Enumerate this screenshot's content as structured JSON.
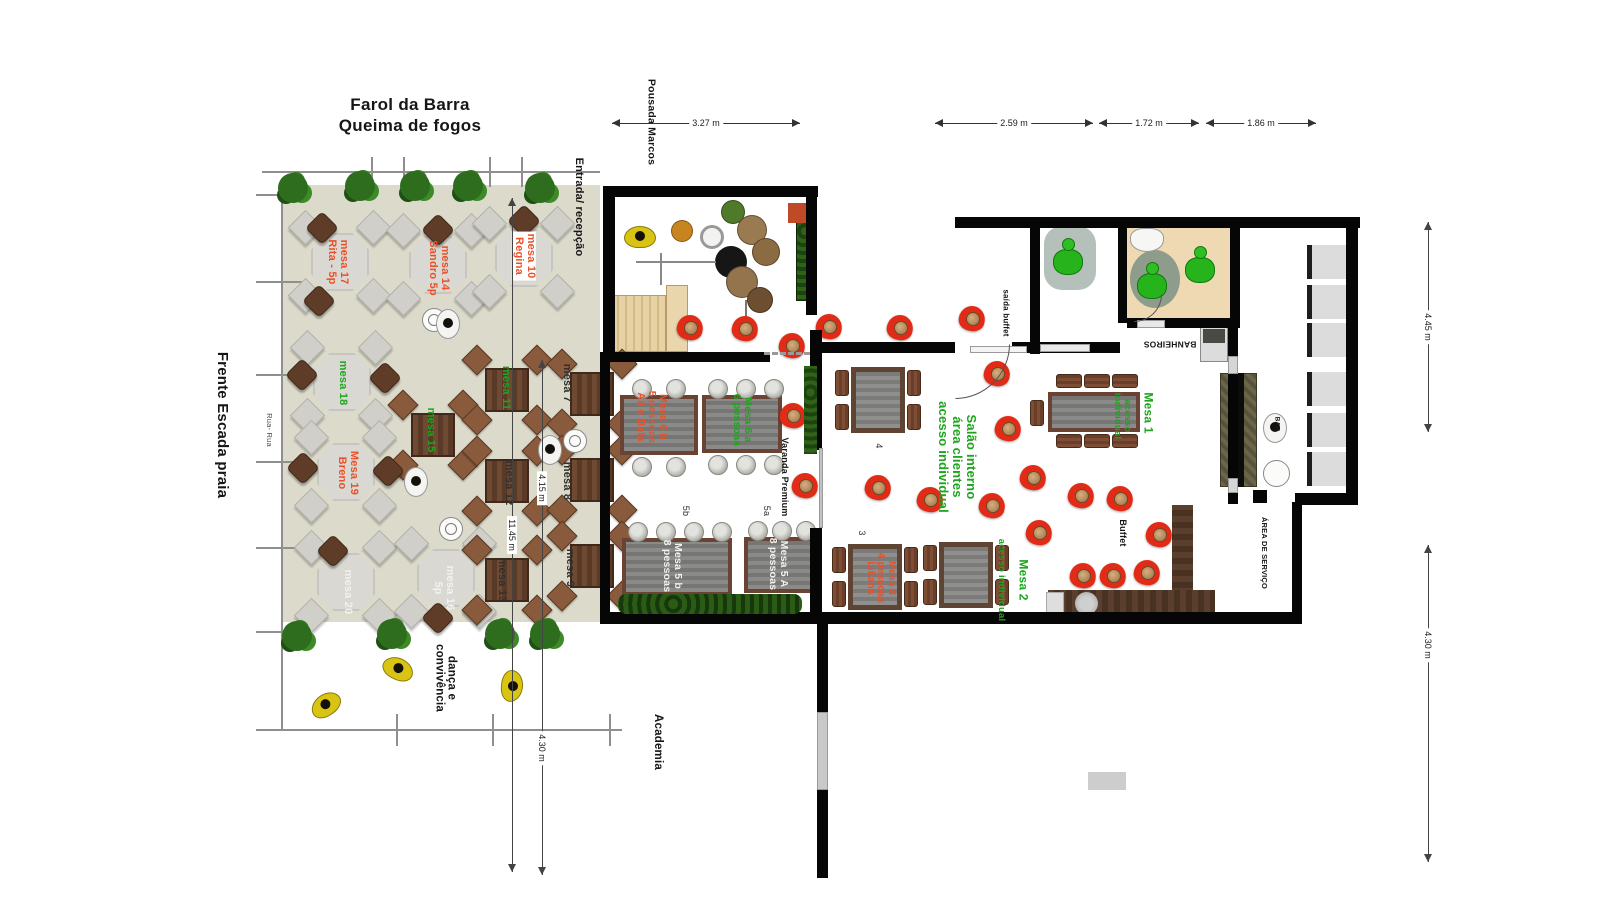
{
  "title": {
    "line1": "Farol da Barra",
    "line2": "Queima de fogos"
  },
  "palette": {
    "red": "#e8512a",
    "green": "#1da51d",
    "dark": "#303030",
    "ink": "#161616",
    "white_label": "#f2f2f0",
    "patio": "#dbdacb",
    "wall": "#060606",
    "red_chair": "#e22b17",
    "hedge": "#1d4410",
    "bathroom_floor": "#eed9b2"
  },
  "labels": [
    {
      "id": "pousada-marcos",
      "text": "Pousada Marcos",
      "x": 651,
      "y": 122,
      "rot": 90,
      "color": "ink",
      "size": 10.5,
      "weight": 700
    },
    {
      "id": "entrada-recepcao",
      "text": "Entrada/ recepção",
      "x": 578,
      "y": 207,
      "rot": 90,
      "color": "ink",
      "size": 11,
      "weight": 700
    },
    {
      "id": "frente-escada-praia",
      "text": "Frente Escada praia",
      "x": 222,
      "y": 425,
      "rot": 90,
      "color": "ink",
      "size": 15,
      "weight": 700
    },
    {
      "id": "rua-rua",
      "text": "Rua- Rua",
      "x": 269,
      "y": 430,
      "rot": 90,
      "color": "#4a4a4a",
      "size": 7.5,
      "weight": 400
    },
    {
      "id": "danca-convivencia",
      "text": "dança e\nconvivência",
      "x": 445,
      "y": 678,
      "rot": 90,
      "color": "ink",
      "size": 11.5,
      "weight": 700
    },
    {
      "id": "academia",
      "text": "Academia",
      "x": 658,
      "y": 742,
      "rot": 90,
      "color": "ink",
      "size": 11.5,
      "weight": 700
    },
    {
      "id": "varanda-premium",
      "text": "Varanda Premium",
      "x": 784,
      "y": 477,
      "rot": 90,
      "color": "ink",
      "size": 9,
      "weight": 700
    },
    {
      "id": "salao-interno",
      "text": "Salão interno\nárea clientes\nacesso individual",
      "x": 957,
      "y": 457,
      "rot": 90,
      "color": "green",
      "size": 13,
      "weight": 700
    },
    {
      "id": "saida-buffet",
      "text": "saída buffet",
      "x": 1005,
      "y": 313,
      "rot": 90,
      "color": "ink",
      "size": 8,
      "weight": 700
    },
    {
      "id": "banheiros",
      "text": "BANHEIROS",
      "x": 1170,
      "y": 344,
      "rot": 180,
      "color": "ink",
      "size": 8.5,
      "weight": 700
    },
    {
      "id": "buffet",
      "text": "Buffet",
      "x": 1122,
      "y": 533,
      "rot": 90,
      "color": "ink",
      "size": 9,
      "weight": 700
    },
    {
      "id": "bar",
      "text": "BAR",
      "x": 1276,
      "y": 424,
      "rot": 90,
      "color": "ink",
      "size": 6.5,
      "weight": 700
    },
    {
      "id": "area-de-servico",
      "text": "ÁREA DE SERVIÇO",
      "x": 1264,
      "y": 553,
      "rot": 90,
      "color": "ink",
      "size": 7.5,
      "weight": 700
    },
    {
      "id": "mesa-7",
      "text": "mesa 7",
      "x": 566,
      "y": 383,
      "rot": 90,
      "color": "dark",
      "size": 11,
      "weight": 700
    },
    {
      "id": "mesa-8",
      "text": "mesa 8",
      "x": 566,
      "y": 481,
      "rot": 90,
      "color": "dark",
      "size": 11,
      "weight": 700
    },
    {
      "id": "mesa-9",
      "text": "mesa 9",
      "x": 569,
      "y": 568,
      "rot": 90,
      "color": "dark",
      "size": 11,
      "weight": 700
    },
    {
      "id": "mesa-17",
      "text": "mesa 17\nRita - 5p",
      "x": 337,
      "y": 262,
      "rot": 90,
      "color": "red",
      "size": 11,
      "weight": 700
    },
    {
      "id": "mesa-14",
      "text": "mesa 14\nSandro 5p",
      "x": 438,
      "y": 268,
      "rot": 90,
      "color": "red",
      "size": 11,
      "weight": 700
    },
    {
      "id": "mesa-10",
      "text": "mesa 10\nRegina",
      "x": 524,
      "y": 256,
      "rot": 90,
      "color": "red",
      "size": 11,
      "weight": 700,
      "bg": "#ffffff"
    },
    {
      "id": "mesa-18",
      "text": "mesa 18",
      "x": 342,
      "y": 383,
      "rot": 90,
      "color": "green",
      "size": 11,
      "weight": 700
    },
    {
      "id": "mesa-15",
      "text": "mesa 15",
      "x": 430,
      "y": 430,
      "rot": 90,
      "color": "green",
      "size": 11,
      "weight": 700
    },
    {
      "id": "mesa-11",
      "text": "mesa 11",
      "x": 505,
      "y": 388,
      "rot": 90,
      "color": "green",
      "size": 11,
      "weight": 700
    },
    {
      "id": "mesa-19",
      "text": "Mesa 19\nBreno",
      "x": 347,
      "y": 473,
      "rot": 90,
      "color": "red",
      "size": 11,
      "weight": 700
    },
    {
      "id": "mesa-12",
      "text": "mesa 12",
      "x": 508,
      "y": 483,
      "rot": 90,
      "color": "dark",
      "size": 11,
      "weight": 700
    },
    {
      "id": "mesa-20",
      "text": "mesa 20",
      "x": 347,
      "y": 592,
      "rot": 90,
      "color": "white_label",
      "size": 11,
      "weight": 700
    },
    {
      "id": "mesa-16",
      "text": "mesa 16\n5p",
      "x": 443,
      "y": 588,
      "rot": 90,
      "color": "white_label",
      "size": 11,
      "weight": 700
    },
    {
      "id": "mesa-13",
      "text": "mesa 13",
      "x": 501,
      "y": 580,
      "rot": 90,
      "color": "dark",
      "size": 11,
      "weight": 700
    },
    {
      "id": "mesa-6b",
      "text": "Mesa 6 b\n5 pessoas\nAli e Bela",
      "x": 651,
      "y": 417,
      "rot": 90,
      "color": "red",
      "size": 10.5,
      "weight": 700
    },
    {
      "id": "mesa-6a",
      "text": "Mesa 6 a\n6 pessoas",
      "x": 742,
      "y": 420,
      "rot": 90,
      "color": "green",
      "size": 10.5,
      "weight": 700
    },
    {
      "id": "label-5b",
      "text": "5b",
      "x": 685,
      "y": 511,
      "rot": 90,
      "color": "dark",
      "size": 9,
      "weight": 400
    },
    {
      "id": "label-5a",
      "text": "5a",
      "x": 766,
      "y": 511,
      "rot": 90,
      "color": "dark",
      "size": 9,
      "weight": 400
    },
    {
      "id": "mesa-5b",
      "text": "Mesa 5 b\n8 pessoas",
      "x": 672,
      "y": 566,
      "rot": 90,
      "color": "white_label",
      "size": 10.5,
      "weight": 700
    },
    {
      "id": "mesa-5a",
      "text": "Mesa 5 A\n8 pessoas",
      "x": 778,
      "y": 564,
      "rot": 90,
      "color": "white_label",
      "size": 10.5,
      "weight": 700
    },
    {
      "id": "label-4",
      "text": "4",
      "x": 878,
      "y": 446,
      "rot": 90,
      "color": "dark",
      "size": 9,
      "weight": 400
    },
    {
      "id": "label-3",
      "text": "3",
      "x": 861,
      "y": 533,
      "rot": 90,
      "color": "dark",
      "size": 9,
      "weight": 400
    },
    {
      "id": "mesa-3",
      "text": "Mesa 3\n4 pessoas\nLiliana",
      "x": 880,
      "y": 578,
      "rot": 90,
      "color": "red",
      "size": 10,
      "weight": 700
    },
    {
      "id": "mesa-2",
      "text": "Mesa 2",
      "x": 1023,
      "y": 580,
      "rot": 90,
      "color": "green",
      "size": 12,
      "weight": 700
    },
    {
      "id": "mesa-2-acesso",
      "text": "acesso individual",
      "x": 1001,
      "y": 580,
      "rot": 90,
      "color": "green",
      "size": 9.5,
      "weight": 700
    },
    {
      "id": "mesa-1",
      "text": "Mesa 1",
      "x": 1148,
      "y": 413,
      "rot": 90,
      "color": "green",
      "size": 12,
      "weight": 700
    },
    {
      "id": "mesa-1-acesso",
      "text": "acesso\nindividual",
      "x": 1122,
      "y": 416,
      "rot": 90,
      "color": "green",
      "size": 9.5,
      "weight": 700
    }
  ],
  "dims": {
    "horizontal": [
      {
        "label": "3.27 m",
        "x1": 612,
        "x2": 800,
        "y": 123
      },
      {
        "label": "2.59 m",
        "x1": 935,
        "x2": 1093,
        "y": 123
      },
      {
        "label": "1.72 m",
        "x1": 1099,
        "x2": 1199,
        "y": 123
      },
      {
        "label": "1.86 m",
        "x1": 1206,
        "x2": 1316,
        "y": 123
      }
    ],
    "vertical": [
      {
        "x": 1428,
        "y1": 222,
        "y2": 432,
        "labels": [
          {
            "text": "4.45 m",
            "cy": 327
          }
        ]
      },
      {
        "x": 1428,
        "y1": 545,
        "y2": 862,
        "labels": [
          {
            "text": "4.30 m",
            "cy": 645
          }
        ]
      },
      {
        "x": 512,
        "y1": 198,
        "y2": 872,
        "labels": [
          {
            "text": "11.45 m",
            "cy": 535
          }
        ]
      },
      {
        "x": 542,
        "y1": 360,
        "y2": 875,
        "labels": [
          {
            "text": "4.15 m",
            "cy": 488
          },
          {
            "text": "4.30 m",
            "cy": 748
          }
        ]
      }
    ]
  },
  "patio": {
    "round_tables": [
      {
        "id": "mesa-17-table",
        "x": 340,
        "y": 262
      },
      {
        "id": "mesa-14-table",
        "x": 438,
        "y": 265
      },
      {
        "id": "mesa-10-table",
        "x": 524,
        "y": 258
      },
      {
        "id": "mesa-18-table",
        "x": 342,
        "y": 382
      },
      {
        "id": "mesa-19-table",
        "x": 346,
        "y": 472
      },
      {
        "id": "mesa-20-table",
        "x": 346,
        "y": 582
      },
      {
        "id": "mesa-16-table",
        "x": 446,
        "y": 578
      }
    ],
    "wood_tables": [
      {
        "id": "mesa-15-table",
        "x": 433,
        "y": 435
      },
      {
        "id": "mesa-11-table",
        "x": 507,
        "y": 390
      },
      {
        "id": "mesa-12-table",
        "x": 507,
        "y": 481
      },
      {
        "id": "mesa-13-table",
        "x": 507,
        "y": 580
      },
      {
        "id": "mesa-7-table",
        "x": 592,
        "y": 394
      },
      {
        "id": "mesa-8-table",
        "x": 592,
        "y": 480
      },
      {
        "id": "mesa-9-table",
        "x": 592,
        "y": 566
      }
    ],
    "brown_chairs": [
      [
        322,
        228
      ],
      [
        319,
        301
      ],
      [
        438,
        230
      ],
      [
        524,
        221
      ],
      [
        302,
        375
      ],
      [
        385,
        378
      ],
      [
        303,
        468
      ],
      [
        388,
        471
      ],
      [
        333,
        551
      ],
      [
        438,
        618
      ]
    ],
    "trees": [
      [
        293,
        188
      ],
      [
        360,
        186
      ],
      [
        415,
        186
      ],
      [
        468,
        186
      ],
      [
        540,
        188
      ],
      [
        297,
        636
      ],
      [
        392,
        634
      ],
      [
        500,
        634
      ],
      [
        545,
        634
      ]
    ]
  },
  "varanda": {
    "amphora_tables": [
      {
        "id": "mesa-6b-table",
        "x": 620,
        "y": 395,
        "w": 78,
        "h": 60,
        "amph": [
          [
            12,
            -16
          ],
          [
            46,
            -16
          ],
          [
            12,
            62
          ],
          [
            46,
            62
          ]
        ]
      },
      {
        "id": "mesa-6a-table",
        "x": 702,
        "y": 395,
        "w": 80,
        "h": 58,
        "amph": [
          [
            6,
            -16
          ],
          [
            34,
            -16
          ],
          [
            62,
            -16
          ],
          [
            6,
            60
          ],
          [
            34,
            60
          ],
          [
            62,
            60
          ]
        ]
      },
      {
        "id": "mesa-5b-table",
        "x": 622,
        "y": 538,
        "w": 110,
        "h": 58,
        "amph": [
          [
            6,
            -16
          ],
          [
            34,
            -16
          ],
          [
            62,
            -16
          ],
          [
            90,
            -16
          ]
        ]
      },
      {
        "id": "mesa-5a-table",
        "x": 744,
        "y": 537,
        "w": 72,
        "h": 56,
        "amph": [
          [
            4,
            -16
          ],
          [
            28,
            -16
          ],
          [
            52,
            -16
          ]
        ]
      }
    ]
  },
  "salao": {
    "square_tables": [
      {
        "id": "table-4",
        "x": 878,
        "y": 400
      },
      {
        "id": "table-3",
        "x": 875,
        "y": 577
      },
      {
        "id": "mesa-2-table",
        "x": 966,
        "y": 575
      }
    ],
    "long_table": {
      "id": "mesa-1-table",
      "x": 1048,
      "y": 392,
      "w": 92,
      "h": 40
    },
    "red_chairs": [
      [
        690,
        327
      ],
      [
        745,
        328
      ],
      [
        792,
        345
      ],
      [
        829,
        326
      ],
      [
        900,
        327
      ],
      [
        972,
        318
      ],
      [
        997,
        373
      ],
      [
        793,
        415
      ],
      [
        805,
        485
      ],
      [
        878,
        487
      ],
      [
        930,
        499
      ],
      [
        1008,
        428
      ],
      [
        1033,
        477
      ],
      [
        992,
        505
      ],
      [
        1039,
        532
      ],
      [
        1081,
        495
      ],
      [
        1120,
        498
      ],
      [
        1159,
        534
      ],
      [
        1083,
        575
      ],
      [
        1113,
        575
      ],
      [
        1147,
        572
      ]
    ]
  },
  "service": {
    "shelves": [
      [
        1307,
        245
      ],
      [
        1307,
        285
      ],
      [
        1307,
        323
      ],
      [
        1307,
        372
      ],
      [
        1307,
        413
      ],
      [
        1307,
        452
      ]
    ]
  },
  "people": {
    "green_figures": [
      [
        1053,
        238
      ],
      [
        1137,
        262
      ],
      [
        1185,
        246
      ]
    ],
    "yellow_people": [
      [
        310,
        694,
        -35
      ],
      [
        382,
        658,
        25
      ],
      [
        496,
        675,
        95
      ],
      [
        624,
        226,
        0
      ]
    ],
    "waiter_trays": [
      [
        434,
        320
      ],
      [
        451,
        529
      ],
      [
        575,
        441
      ]
    ],
    "waiter_persons": [
      [
        448,
        324
      ],
      [
        416,
        482
      ],
      [
        550,
        450
      ],
      [
        1275,
        428
      ]
    ]
  }
}
